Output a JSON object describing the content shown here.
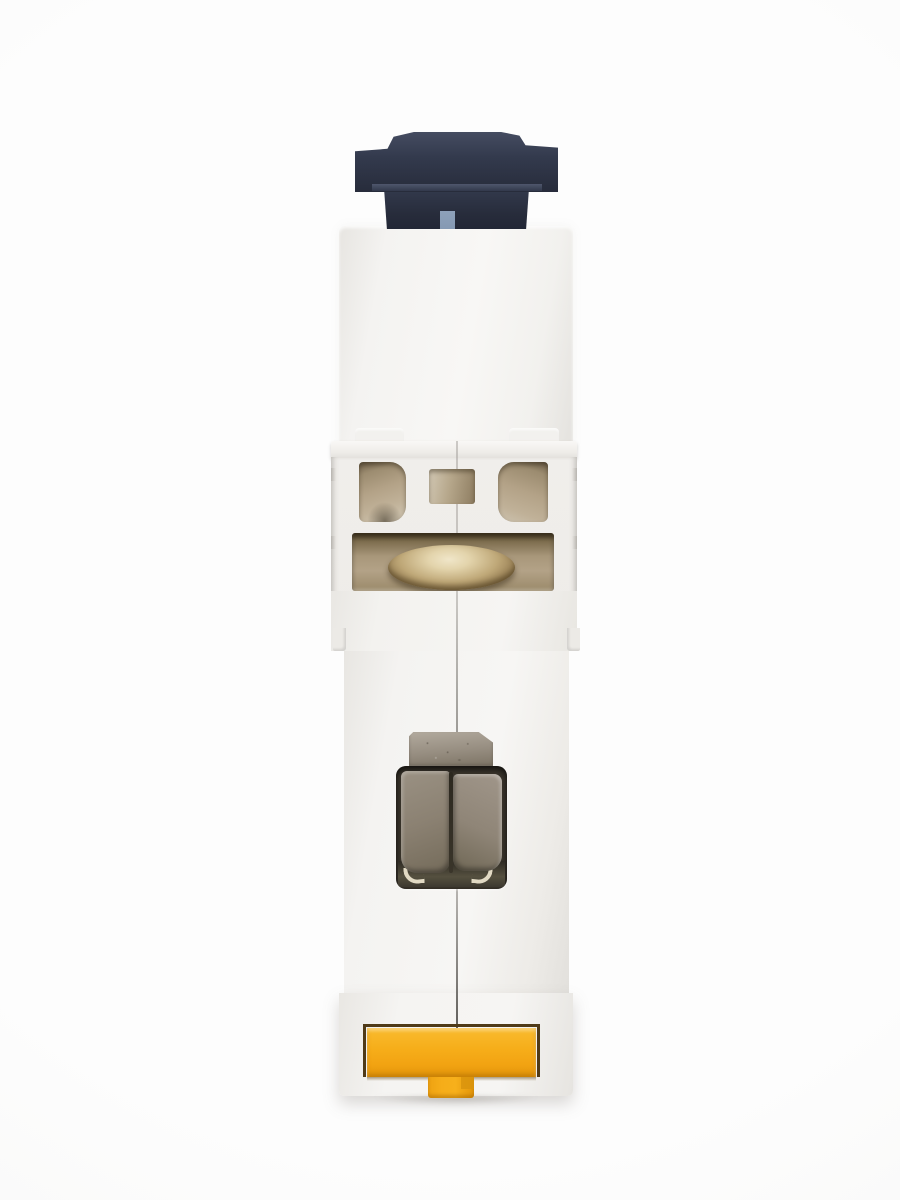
{
  "image": {
    "type": "product-photo",
    "subject": "single-module DIN-rail miniature circuit breaker, rear/side view",
    "orientation": "vertical",
    "visible_text": ""
  },
  "parts": {
    "device": "miniature circuit breaker rear view",
    "toggle": "dark blue-gray toggle switch",
    "toggle_indicator": "light blue indicator square on toggle stem",
    "upper_housing": "white upper housing block",
    "mount_bumps": "raised mounting bumps",
    "ledge": "housing step ledge",
    "vent_left": "left rounded vent opening",
    "vent_center": "center rectangular vent opening",
    "vent_right": "right rounded vent opening",
    "screw_recess": "terminal screw recess",
    "terminal_screw": "brass terminal screw head",
    "housing_seam": "center seam between housing halves",
    "metal_tab": "weathered metal contact tab",
    "terminal_window": "terminal clamp window",
    "clamp_left": "left metal clamp plate",
    "clamp_right": "right metal clamp plate",
    "clamp_hooks": "bright metal spring hooks",
    "din_clip": "yellow DIN-rail release clip",
    "din_clip_stem": "yellow clip pull stem",
    "lower_housing": "white lower housing block",
    "base": "white housing base"
  },
  "colors": {
    "bg": "#fdfdfd",
    "bg_vignette": "#f4f4f2",
    "toggle_top": "#454c61",
    "toggle_face": "#333a4d",
    "toggle_dark": "#272c3b",
    "toggle_ridge": "#535b71",
    "toggle_dot": "#8599b3",
    "opening_tan": "#b3a287",
    "opening_tan_light": "#d3c9b6",
    "brass_light": "#f0e6c9",
    "brass": "#bfa878",
    "brass_dark": "#6e5b3e",
    "clamp": "#8b8172",
    "window_dark": "#3a352c",
    "hook": "#e2dac4",
    "tab_metal_light": "#b2aa9e",
    "tab_metal": "#968d80",
    "tab_metal_dark": "#7b7263",
    "clip_yellow": "#f6ad19",
    "clip_yellow_dark": "#e2950a",
    "clip_frame": "#4f3a18"
  }
}
